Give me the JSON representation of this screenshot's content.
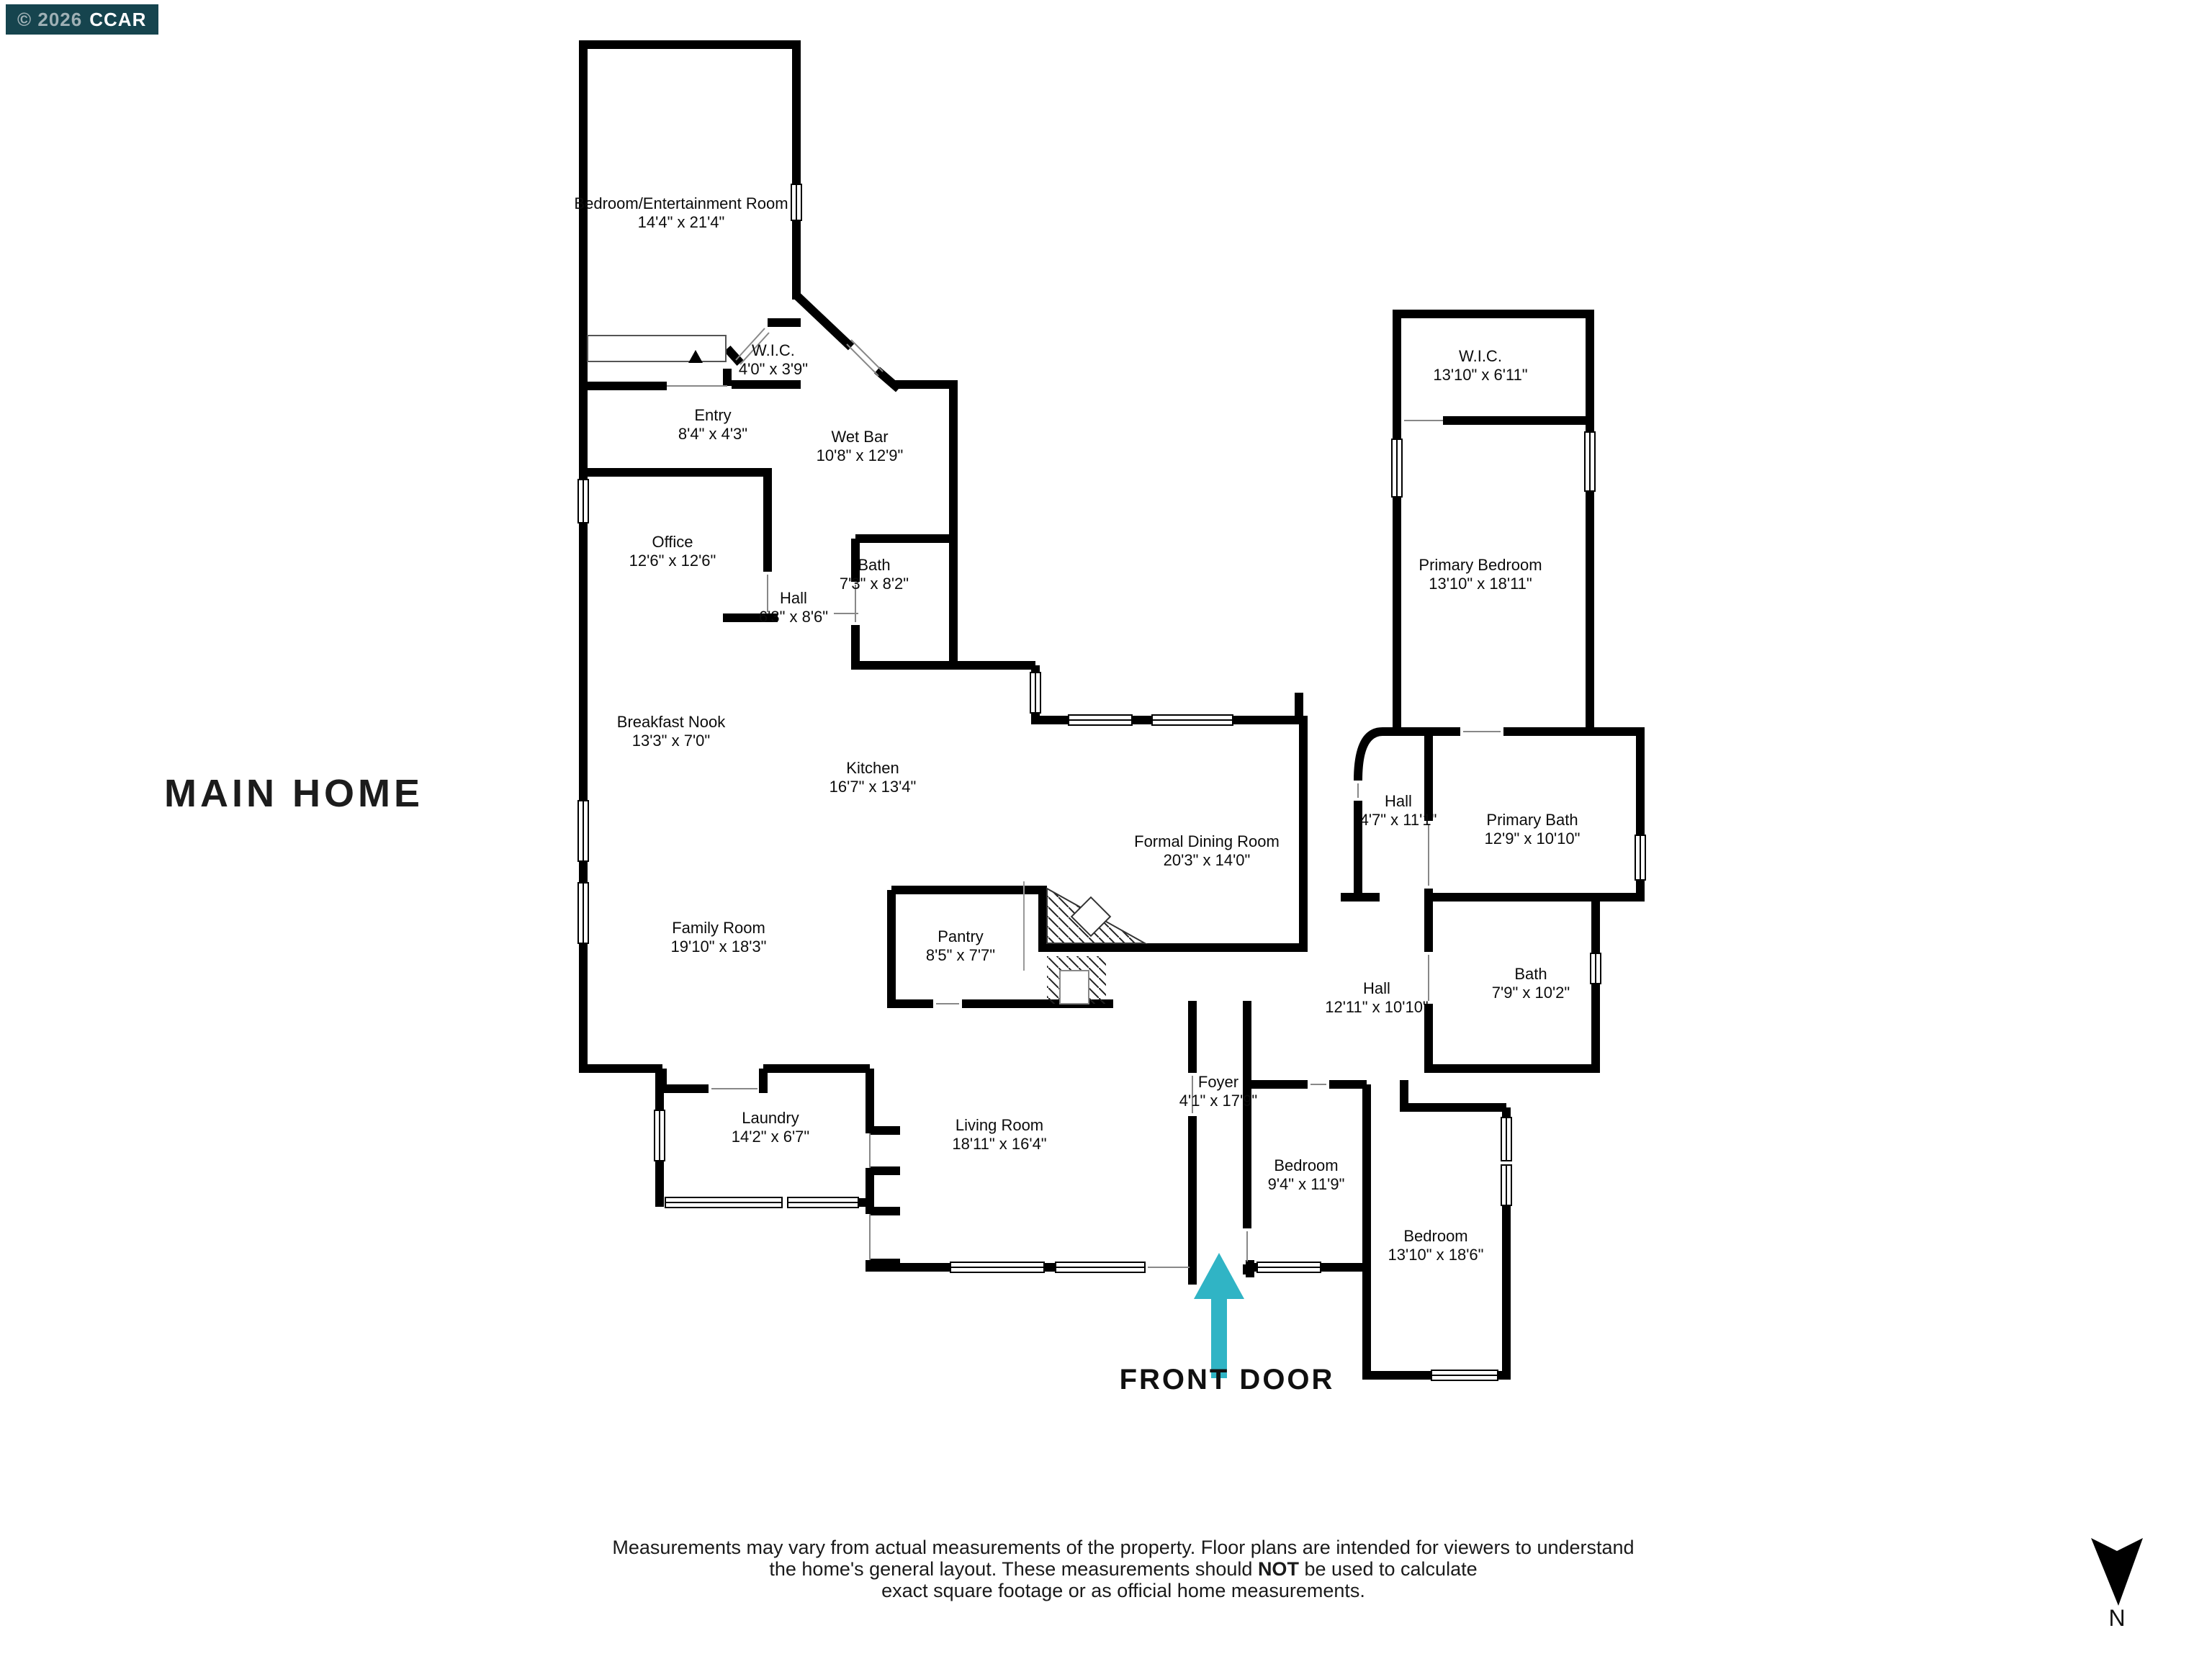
{
  "badge": {
    "copyright": "© 2026",
    "brand": "CCAR"
  },
  "title": "MAIN HOME",
  "colors": {
    "arrow": "#30b4c5",
    "badge_bg": "#16444e",
    "wall": "#000000"
  },
  "front_door": {
    "label": "FRONT DOOR"
  },
  "compass": {
    "label": "N"
  },
  "disclaimer": {
    "line1": "Measurements may vary from actual measurements of the property. Floor plans are intended for viewers to understand",
    "line2_pre": "the home's general layout.  These measurements should ",
    "line2_bold": "NOT",
    "line2_post": " be used to calculate",
    "line3": "exact square footage or as official home measurements."
  },
  "rooms": [
    {
      "name": "Bedroom/Entertainment Room",
      "dims": "14'4\" x 21'4\""
    },
    {
      "name": "W.I.C.",
      "dims": "4'0\" x 3'9\""
    },
    {
      "name": "Entry",
      "dims": "8'4\" x 4'3\""
    },
    {
      "name": "Wet Bar",
      "dims": "10'8\" x 12'9\""
    },
    {
      "name": "Office",
      "dims": "12'6\" x 12'6\""
    },
    {
      "name": "Bath",
      "dims": "7'3\" x 8'2\""
    },
    {
      "name": "Hall",
      "dims": "6'3\" x 8'6\""
    },
    {
      "name": "Breakfast Nook",
      "dims": "13'3\" x 7'0\""
    },
    {
      "name": "Kitchen",
      "dims": "16'7\" x 13'4\""
    },
    {
      "name": "Formal Dining Room",
      "dims": "20'3\" x 14'0\""
    },
    {
      "name": "Hall",
      "dims": "4'7\" x 11'1\""
    },
    {
      "name": "W.I.C.",
      "dims": "13'10\" x 6'11\""
    },
    {
      "name": "Primary Bedroom",
      "dims": "13'10\" x 18'11\""
    },
    {
      "name": "Primary Bath",
      "dims": "12'9\" x 10'10\""
    },
    {
      "name": "Family Room",
      "dims": "19'10\" x 18'3\""
    },
    {
      "name": "Pantry",
      "dims": "8'5\" x 7'7\""
    },
    {
      "name": "Hall",
      "dims": "12'11\" x 10'10\""
    },
    {
      "name": "Bath",
      "dims": "7'9\" x 10'2\""
    },
    {
      "name": "Foyer",
      "dims": "4'1\" x 17'9\""
    },
    {
      "name": "Laundry",
      "dims": "14'2\" x 6'7\""
    },
    {
      "name": "Living Room",
      "dims": "18'11\" x 16'4\""
    },
    {
      "name": "Bedroom",
      "dims": "9'4\" x 11'9\""
    },
    {
      "name": "Bedroom",
      "dims": "13'10\" x 18'6\""
    }
  ]
}
